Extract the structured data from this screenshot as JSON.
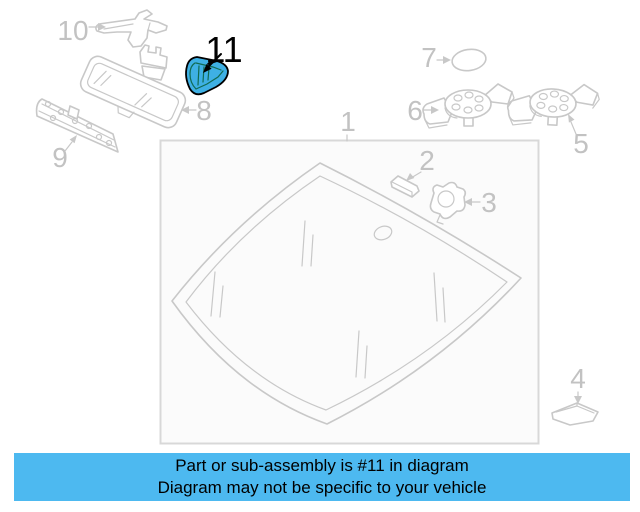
{
  "banner": {
    "line1": "Part or sub-assembly is #11 in diagram",
    "line2": "Diagram may not be specific to your vehicle",
    "background_color": "#4db9f0",
    "text_color": "#000000"
  },
  "diagram": {
    "highlighted_part_number": "11",
    "labels": {
      "l1": "1",
      "l2": "2",
      "l3": "3",
      "l4": "4",
      "l5": "5",
      "l6": "6",
      "l7": "7",
      "l8": "8",
      "l9": "9",
      "l10": "10",
      "l11": "11"
    },
    "colors": {
      "line_gray": "#c8c8c8",
      "label_gray": "#c2c2c2",
      "box_border": "#d8d8d8",
      "box_fill": "#fbfbfb",
      "highlight_fill": "#3eb0e4",
      "highlight_stroke": "#000000",
      "highlight_detail": "#116b52"
    }
  }
}
